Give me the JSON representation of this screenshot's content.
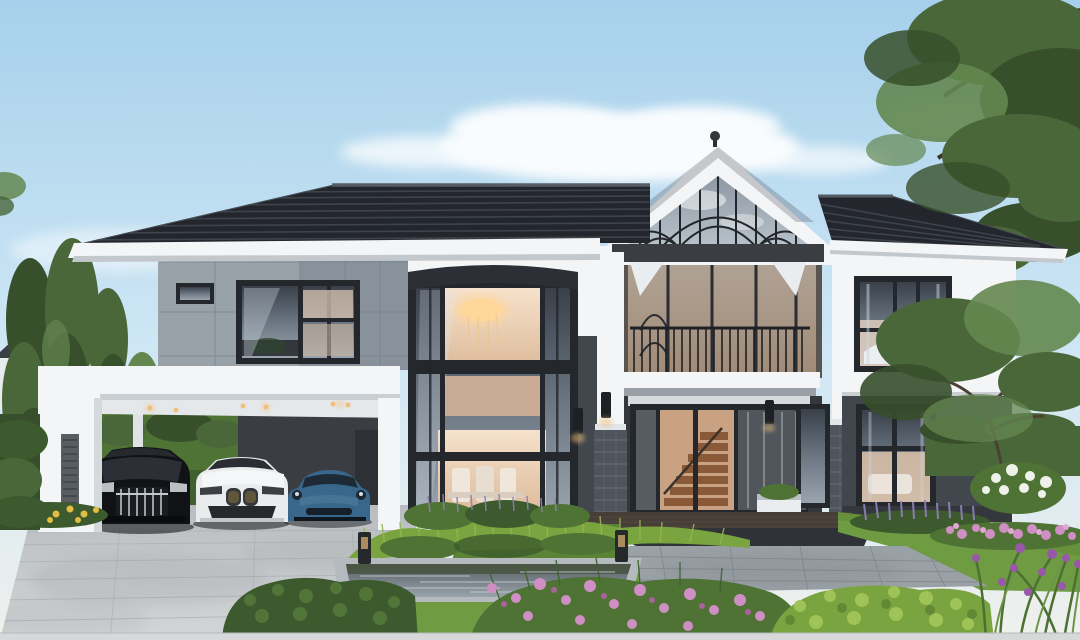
{
  "scene": {
    "type": "natural-image",
    "subject": "Modern two-storey luxury house exterior",
    "setting": "Front yard with carport, reflecting pond, stone patio, lawns and flower beds at dusk",
    "aria_label": "Architectural rendering of a modern grey and white two-storey house with a central glass gable entrance, a carport sheltering three cars, tall trees, and a landscaped garden with a rectangular reflecting pond"
  },
  "objects": {
    "cars": [
      {
        "label": "black luxury van"
      },
      {
        "label": "white suv"
      },
      {
        "label": "blue sports coupe"
      }
    ],
    "landscape": [
      "poplar trees",
      "overhanging tree",
      "garden tree",
      "hedges",
      "pink flower shrubs",
      "lavender border",
      "purple iris",
      "yellow flowers",
      "reflecting pond",
      "bollard lights"
    ],
    "house_parts": [
      "tiled hip roof",
      "glass gable",
      "balcony",
      "bay window",
      "entry doors with staircase view",
      "stone columns",
      "carport",
      "bedroom window",
      "living room windows",
      "wall sconces"
    ]
  },
  "palette": {
    "sky_top": "#a6d0eb",
    "sky_mid": "#cfe7f5",
    "sky_horizon": "#eff0ec",
    "cloud": "#ffffff",
    "roof_dark": "#23262c",
    "roof_row": "#3e444c",
    "roof_ridge": "#555c64",
    "trim_white": "#f3f5f6",
    "trim_shade": "#dde2e5",
    "fascia_shadow": "#c2c8cc",
    "wall_gray_light": "#99a2a9",
    "wall_gray_dark": "#89929a",
    "panel_line": "#76808a",
    "wall_dark": "#42474d",
    "wall_darker": "#34383d",
    "frame_dark": "#24272c",
    "glass_sky": "#aeb9c2",
    "glass_warm": "#f3dcc5",
    "glass_warm_deep": "#dfbda0",
    "chandelier": "#ffd79a",
    "stone_dark": "#4e545b",
    "stone_light": "#6a7178",
    "deck_wood": "#473e38",
    "deck_band": "#2f3337",
    "drive_light": "#cbcfd1",
    "drive_joint": "#aeb3b6",
    "patio": "#9aa1a6",
    "patio_joint": "#82898e",
    "pond_rim": "#b4babd",
    "lawn": "#6f9b43",
    "lawn_shade": "#5a8336",
    "hedge_dark": "#3c5a2d",
    "hedge_mid": "#4e7334",
    "hedge_yellow": "#79a43f",
    "tree_green": "#4a673a",
    "tree_dark": "#374f2b",
    "tree_light": "#648750",
    "flower_pink": "#cf8fc4",
    "flower_purple": "#8d7fb5",
    "flower_iris": "#9857a8",
    "flower_yellow": "#e3bc42",
    "flower_white": "#eef2ea",
    "car_black": "#101216",
    "car_white": "#e9ebed",
    "car_blue": "#39678c",
    "light_warm": "#f0c07a"
  }
}
